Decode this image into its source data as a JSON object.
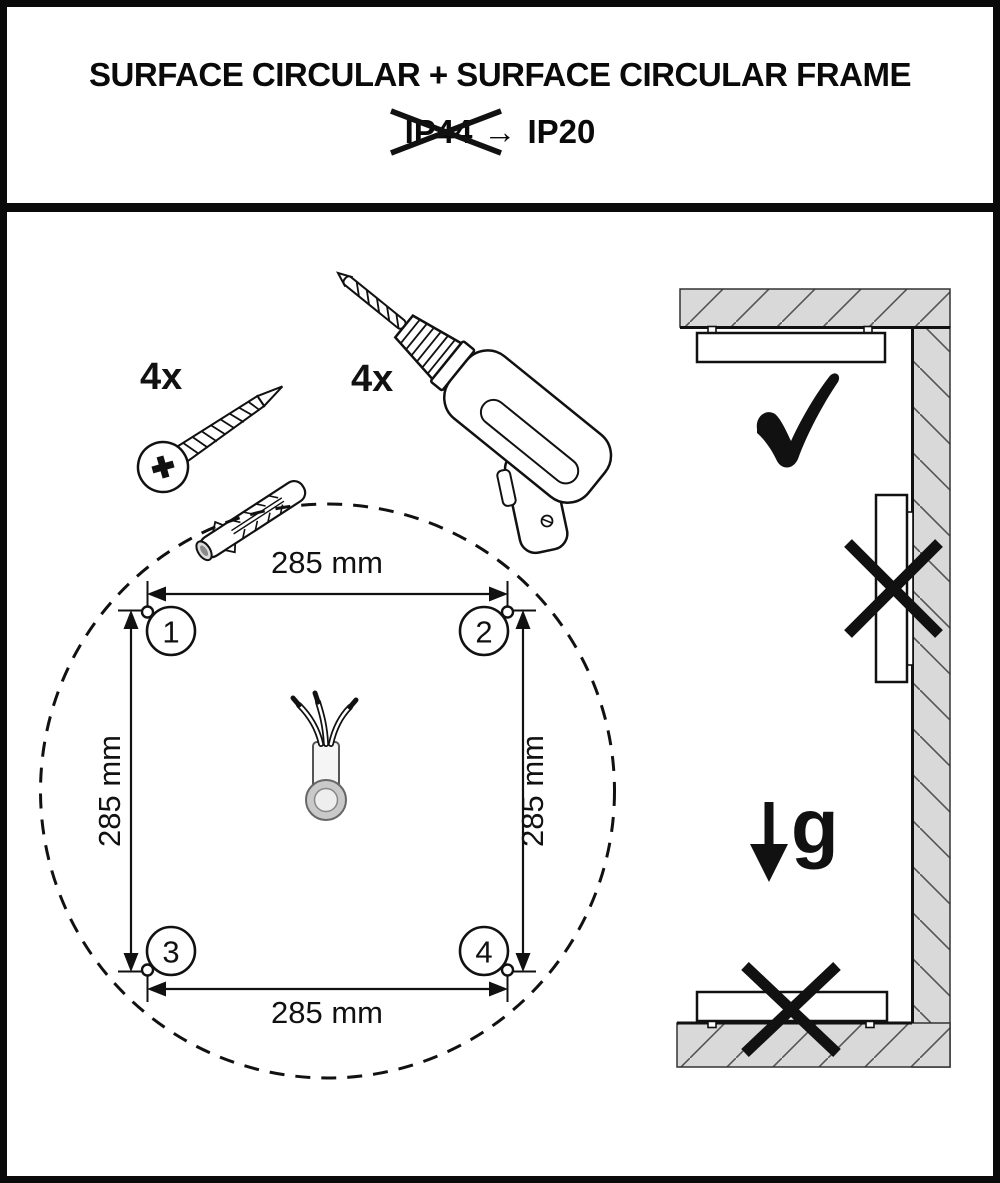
{
  "header": {
    "title": "SURFACE CIRCULAR + SURFACE CIRCULAR FRAME",
    "ip_old": "IP44",
    "arrow": "→",
    "ip_new": "IP20"
  },
  "parts": {
    "screw_qty": "4x",
    "drill_qty": "4x"
  },
  "template": {
    "dim_top": "285 mm",
    "dim_bottom": "285 mm",
    "dim_left": "285 mm",
    "dim_right": "285 mm",
    "hole_1": "1",
    "hole_2": "2",
    "hole_3": "3",
    "hole_4": "4"
  },
  "mounting": {
    "gravity_label": "g"
  },
  "colors": {
    "ink": "#111111",
    "hatch_fill": "#d9d9d9",
    "hatch_line": "#555555"
  }
}
